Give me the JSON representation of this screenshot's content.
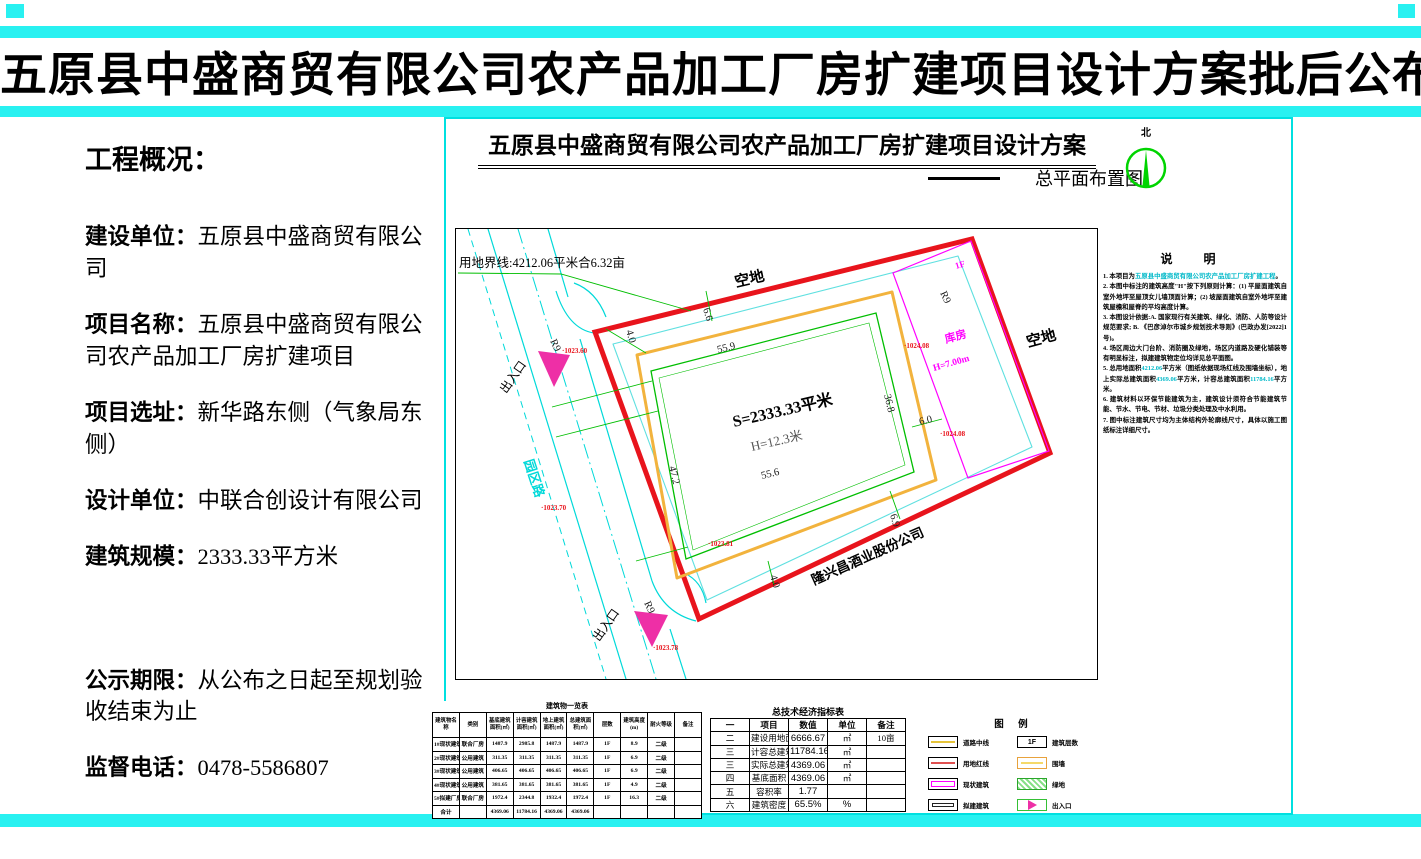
{
  "page_title": "五原县中盛商贸有限公司农产品加工厂房扩建项目设计方案批后公布",
  "overview": {
    "heading": "工程概况：",
    "items": [
      {
        "label": "建设单位：",
        "value": "五原县中盛商贸有限公司"
      },
      {
        "label": "项目名称：",
        "value": "五原县中盛商贸有限公司农产品加工厂房扩建项目"
      },
      {
        "label": "项目选址：",
        "value": "新华路东侧（气象局东侧）"
      },
      {
        "label": "设计单位：",
        "value": "中联合创设计有限公司"
      },
      {
        "label": "建筑规模：",
        "value": "2333.33平方米"
      },
      {
        "label": "公示期限：",
        "value": "从公布之日起至规划验收结束为止"
      },
      {
        "label": "监督电话：",
        "value": "0478-5586807"
      }
    ]
  },
  "drawing": {
    "title": "五原县中盛商贸有限公司农产品加工厂房扩建项目设计方案",
    "plan_label": "总平面布置图",
    "north_label": "北",
    "boundary_label": "用地界线:4212.06平米合6.32亩",
    "labels": {
      "empty_top": "空地",
      "empty_right": "空地",
      "entrance_top": "出入口",
      "entrance_bottom": "出入口",
      "road": "园区路",
      "neighbor": "隆兴昌酒业股份公司",
      "building_area": "S=2333.33平米",
      "building_height": "H=12.3米",
      "warehouse": "库房",
      "warehouse_height": "H=7.00m",
      "warehouse_floor": "1F"
    },
    "dims": {
      "d40_top": "4.0",
      "d66": "6.6",
      "d559": "55.9",
      "d472": "47.2",
      "d556": "55.6",
      "d368": "36.8",
      "d60": "6.0",
      "d69": "6.9",
      "d40_bottom": "4.0",
      "r9": "R9"
    },
    "elevations": {
      "e1": "·1023.60",
      "e2": "·1023.70",
      "e3": "·1023.81",
      "e4": "·1023.78",
      "e5": "·1024.08",
      "e6": "·1024.08"
    }
  },
  "notes": {
    "title": "说  明",
    "items": [
      {
        "parts": [
          {
            "t": "1. 本项目为"
          },
          {
            "t": "五原县中盛商贸有限公司农产品加工厂房扩建工程",
            "hl": true
          },
          {
            "t": "。"
          }
        ]
      },
      {
        "parts": [
          {
            "t": "2. 本图中标注的建筑高度\"H\"按下列原则计算：(1) 平屋面建筑自室外地坪至屋顶女儿墙顶面计算；(2) 坡屋面建筑自室外地坪至建筑屋檐和屋脊的平均高度计算。"
          }
        ]
      },
      {
        "parts": [
          {
            "t": "3. 本图设计依据:A. 国家现行有关建筑、绿化、消防、人防等设计规范要求; B. 《巴彦淖尔市城乡规划技术导则》(巴政办发[2022]1号)。"
          }
        ]
      },
      {
        "parts": [
          {
            "t": "4. 场区周边大门台阶、消防圈及绿地，场区内道路及硬化铺装等有明显标注，拟建建筑物定位均详见总平面图。"
          }
        ]
      },
      {
        "parts": [
          {
            "t": "5. 总用地面积"
          },
          {
            "t": "4212.06",
            "hl": true
          },
          {
            "t": "平方米（图纸依据现场红线及围墙坐标），地上实际总建筑面积"
          },
          {
            "t": "4369.06",
            "hl": true
          },
          {
            "t": "平方米，计容总建筑面积"
          },
          {
            "t": "11784.16",
            "hl": true
          },
          {
            "t": "平方米。"
          }
        ]
      },
      {
        "parts": [
          {
            "t": "6. 建筑材料以环保节能建筑为主，建筑设计须符合节能建筑节能、节水、节电、节材、垃圾分类处理及中水利用。"
          }
        ]
      },
      {
        "parts": [
          {
            "t": "7. 图中标注建筑尺寸均为主体结构外轮廓线尺寸，具体以施工图纸标注详细尺寸。"
          }
        ]
      }
    ]
  },
  "building_table": {
    "title": "建筑物一览表",
    "headers": [
      "建筑物名称",
      "类别",
      "基底建筑面积(㎡)",
      "计容建筑面积(㎡)",
      "地上建筑面积(㎡)",
      "总建筑面积(㎡)",
      "层数",
      "建筑高度(m)",
      "耐火等级",
      "备注"
    ],
    "rows": [
      [
        "1#现状建筑物",
        "联合厂房",
        "1487.9",
        "2985.8",
        "1487.9",
        "1487.9",
        "1F",
        "8.9",
        "二级",
        ""
      ],
      [
        "2#现状建筑物",
        "公用建筑",
        "311.35",
        "311.35",
        "311.35",
        "311.35",
        "1F",
        "6.9",
        "二级",
        ""
      ],
      [
        "3#现状建筑物",
        "公用建筑",
        "406.65",
        "406.65",
        "406.65",
        "406.65",
        "1F",
        "6.9",
        "二级",
        ""
      ],
      [
        "4#现状建筑物",
        "公用建筑",
        "381.65",
        "381.65",
        "381.65",
        "381.65",
        "1F",
        "4.9",
        "二级",
        ""
      ],
      [
        "5#拟建厂房",
        "联合厂房",
        "1972.4",
        "2344.8",
        "1932.4",
        "1972.4",
        "1F",
        "16.3",
        "二级",
        ""
      ],
      [
        "合计",
        "",
        "4369.06",
        "11784.16",
        "4369.06",
        "4369.06",
        "",
        "",
        "",
        ""
      ]
    ]
  },
  "summary_table": {
    "title": "总技术经济指标表",
    "rows": [
      [
        "一",
        "项目",
        "数值",
        "单位",
        "备注"
      ],
      [
        "二",
        "建设用地面积",
        "6666.67",
        "㎡",
        "10亩"
      ],
      [
        "三",
        "计容总建筑面积",
        "11784.16",
        "㎡",
        ""
      ],
      [
        "三",
        "实际总建筑面积",
        "4369.06",
        "㎡",
        ""
      ],
      [
        "四",
        "基底面积",
        "4369.06",
        "㎡",
        ""
      ],
      [
        "五",
        "容积率",
        "1.77",
        "",
        ""
      ],
      [
        "六",
        "建筑密度",
        "65.5%",
        "%",
        ""
      ]
    ]
  },
  "legend": {
    "title": "图 例",
    "items": [
      {
        "swatch": "road-centerline",
        "label": "道路中线",
        "glyph": ""
      },
      {
        "swatch": "red-boundary",
        "label": "用地红线",
        "glyph": ""
      },
      {
        "swatch": "existing-building",
        "label": "现状建筑",
        "glyph": ""
      },
      {
        "swatch": "proposed-building",
        "label": "拟建建筑",
        "glyph": ""
      },
      {
        "swatch": "floor-count",
        "label": "建筑层数",
        "glyph": "1F"
      },
      {
        "swatch": "wall",
        "label": "围墙",
        "glyph": ""
      },
      {
        "swatch": "greenery",
        "label": "绿地",
        "glyph": ""
      },
      {
        "swatch": "entrance",
        "label": "出入口",
        "glyph": ""
      }
    ]
  },
  "colors": {
    "cyan_bar": "#29f1f1",
    "boundary_red": "#e8141c",
    "wall_orange": "#f2b33d",
    "cad_green": "#00be00",
    "road_cyan": "#00d9d9",
    "magenta": "#ff00ff",
    "entrance_pink": "#ee2fa6",
    "elevation_red": "#e8141c"
  }
}
